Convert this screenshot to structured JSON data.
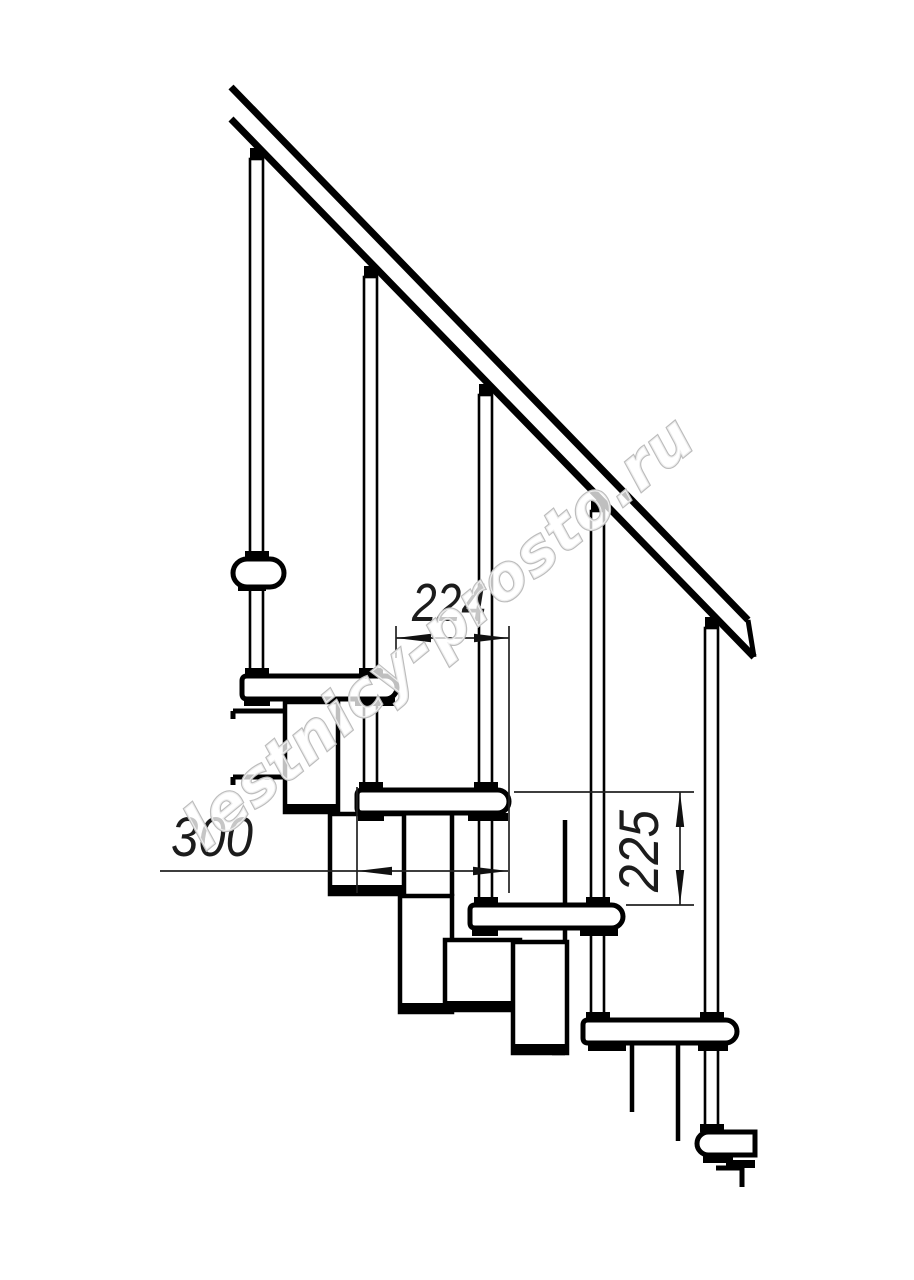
{
  "drawing": {
    "title": "staircase-side-view-technical-drawing",
    "line_color": "#000000",
    "dim_color": "#222222",
    "background": "#ffffff",
    "dimensions": {
      "run": {
        "value": "224",
        "orientation": "horizontal"
      },
      "tread_depth": {
        "value": "300",
        "orientation": "horizontal"
      },
      "riser": {
        "value": "225",
        "orientation": "vertical"
      }
    },
    "watermark": {
      "text": "lestnicy-prosto.ru",
      "color": "#bcbcbc"
    }
  }
}
